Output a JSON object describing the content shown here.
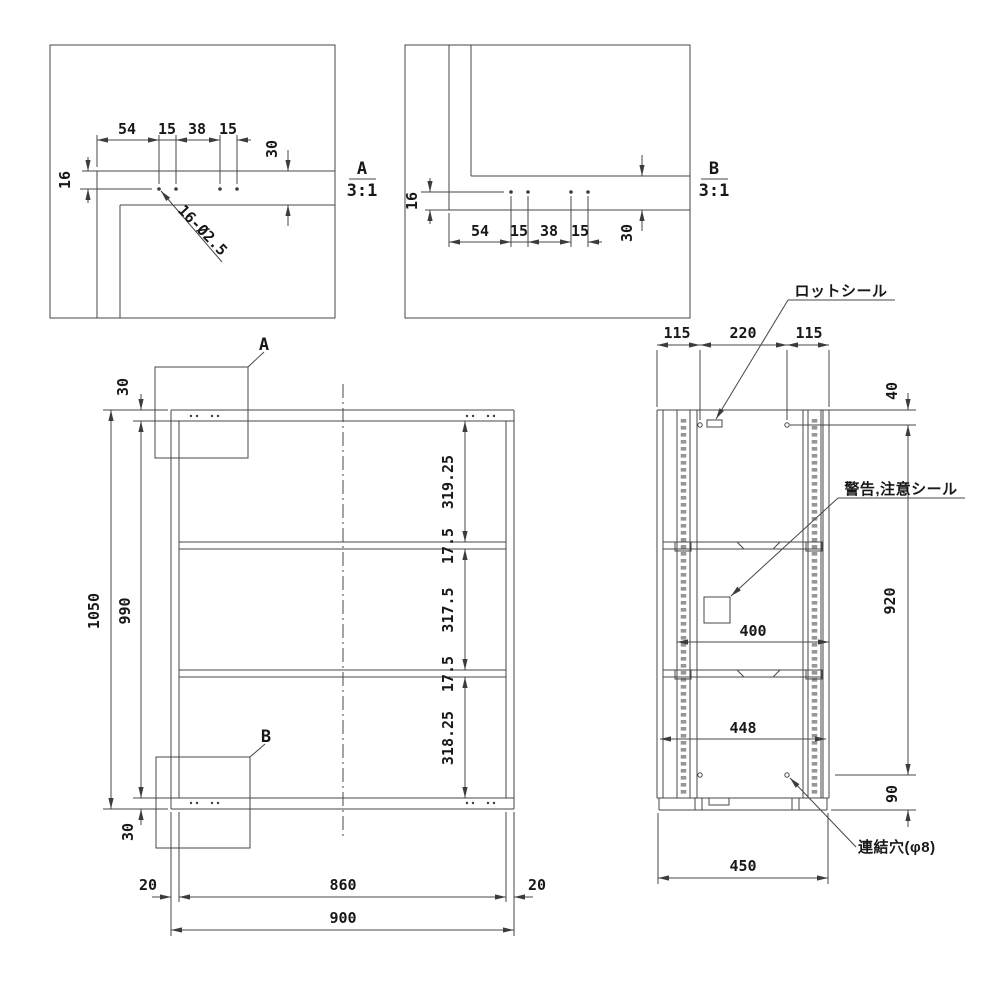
{
  "drawing": {
    "a": {
      "label": "A",
      "scale": "3:1",
      "chain": [
        "54",
        "15",
        "38",
        "15"
      ],
      "edge": "16",
      "band": "30",
      "note": "16-Ø2.5"
    },
    "b": {
      "label": "B",
      "scale": "3:1",
      "chain": [
        "54",
        "15",
        "38",
        "15"
      ],
      "edge": "16",
      "band": "30"
    },
    "front": {
      "callout_a": "A",
      "callout_b": "B",
      "top_offset": "30",
      "height": "1050",
      "inner_height": "990",
      "bottom_offset": "30",
      "bays": [
        "319.25",
        "17.5",
        "317.5",
        "17.5",
        "318.25"
      ],
      "side_wall_l": "20",
      "inner_width": "860",
      "side_wall_r": "20",
      "width": "900"
    },
    "side": {
      "front_margin": "115",
      "mid": "220",
      "back_margin": "115",
      "top_hole": "40",
      "hole_span": "920",
      "bottom_hole": "90",
      "shelf_depth": "400",
      "inner_depth": "448",
      "depth": "450",
      "lot_seal": "ロットシール",
      "warning_seal": "警告,注意シール",
      "joint_hole": "連結穴(φ8)"
    }
  }
}
